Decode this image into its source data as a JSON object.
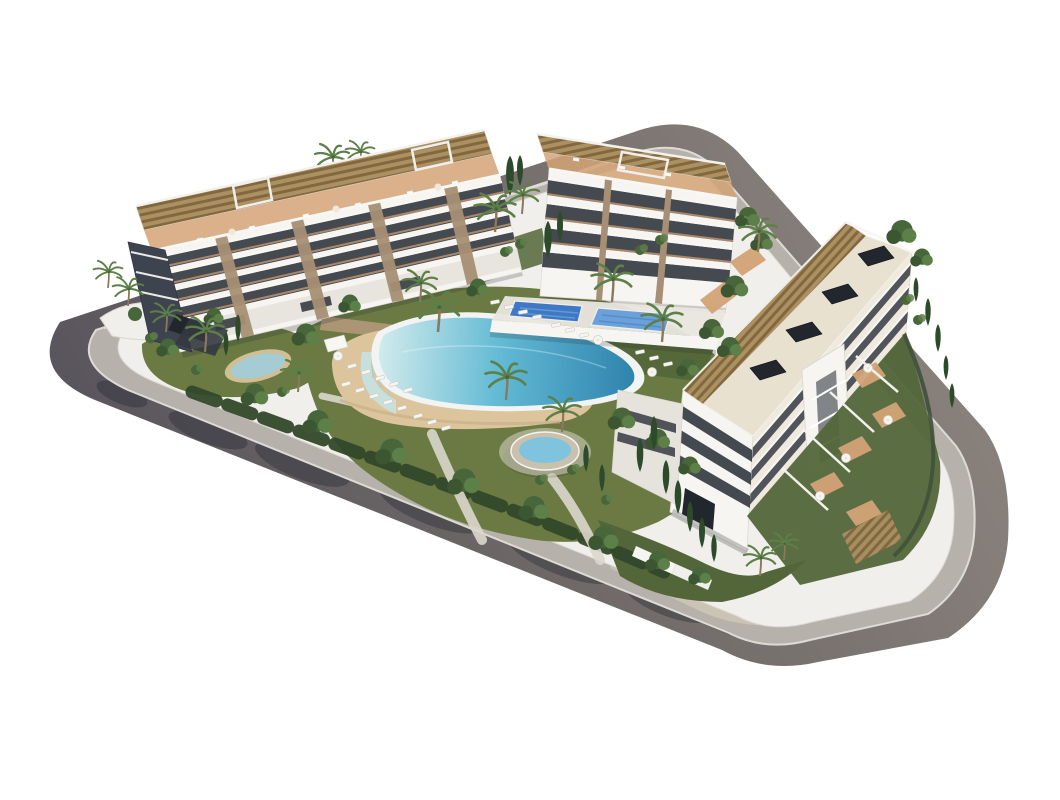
{
  "colors": {
    "background": "#ffffff",
    "road_dark": "#54505a",
    "road_mid": "#6e6967",
    "road_light": "#8f8781",
    "sidewalk": "#b7b1ab",
    "sidewalk_beige": "#cbc3b4",
    "curb": "#dedbd5",
    "wall_white": "#f1efeb",
    "lawn": "#6a7a42",
    "lawn_dark": "#52663a",
    "shrub": "#32482a",
    "canopy": "#47663a",
    "canopy_light": "#5d7f48",
    "cypress": "#2d4a2a",
    "trunk": "#8a795c",
    "sand": "#dcc59d",
    "sand_shade": "#c4ab83",
    "stonewall": "#b09778",
    "pond": "#a4ccd2",
    "pool_rim": "#f2f4f3",
    "pool_pale": "#cfeaec",
    "pool_mid": "#62bad4",
    "pool_deep": "#2b7fab",
    "infinity_wall": "#c7e0dc",
    "tile_pool": "#3f78c4",
    "tile_pool_light": "#6ba0d8",
    "spa_ring": "#c9c0ad",
    "spa_water": "#7fc4dc",
    "deck": "#e9e6df",
    "path_light": "#dbd7cc",
    "bldg_white": "#f6f5f1",
    "bldg_shade": "#e6e3dc",
    "bldg_cream": "#f0eade",
    "cream_roof": "#e8e1d0",
    "endwall": "#3e4350",
    "glass_dark": "#363b43",
    "glass_deep": "#22262d",
    "terracotta": "#d3a376",
    "terracotta_deep": "#bd8a5e",
    "pergola": "#ab9062",
    "pergola_slat": "#83683f",
    "stone": "#a68f74",
    "shadow": "#262a33",
    "parapet_white": "#f8f7f4",
    "fence": "#3f5138",
    "ramp_dark": "#34383f"
  }
}
